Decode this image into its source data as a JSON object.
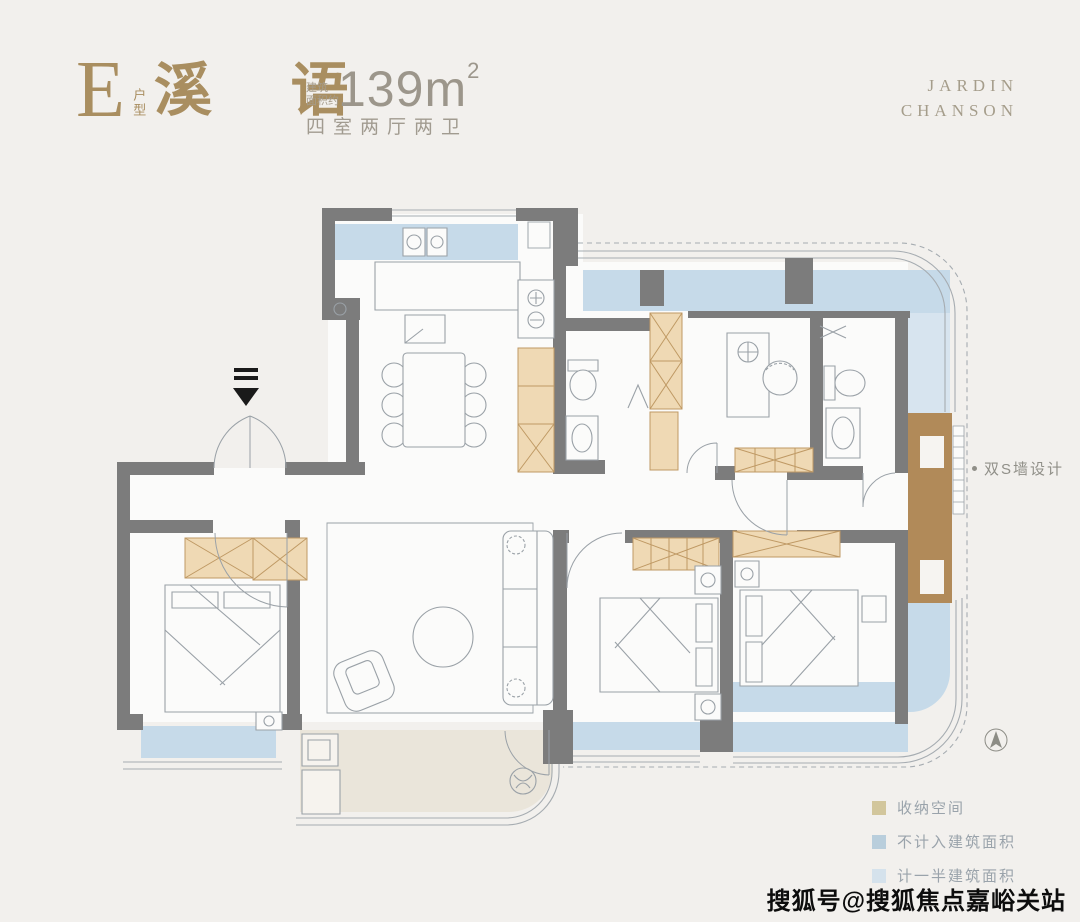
{
  "header": {
    "unit_letter": "E",
    "unit_label": "户型",
    "name": "溪 语",
    "area_prefix_top": "建筑",
    "area_prefix_bottom": "面积约",
    "area_value": "139",
    "area_unit": "m",
    "area_sup": "2",
    "rooms": "四室两厅两卫"
  },
  "brand": {
    "line1": "JARDIN",
    "line2": "CHANSON"
  },
  "annotation": {
    "double_s_wall": "双S墙设计"
  },
  "legend": {
    "items": [
      {
        "label": "收纳空间",
        "color": "#d2c69c"
      },
      {
        "label": "不计入建筑面积",
        "color": "#b9cedc"
      },
      {
        "label": "计一半建筑面积",
        "color": "#d5e2ec"
      }
    ]
  },
  "watermark": "搜狐号@搜狐焦点嘉峪关站",
  "colors": {
    "accent_gold": "#a98e60",
    "muted_text": "#9c968b",
    "wall_gray": "#7c7c7c",
    "balcony_blue": "#c6dae9",
    "half_area_blue": "#d7e4ef",
    "storage_tan": "#efd9b4",
    "storage_brown": "#b18a59",
    "outdoor_beige": "#eae5da"
  }
}
